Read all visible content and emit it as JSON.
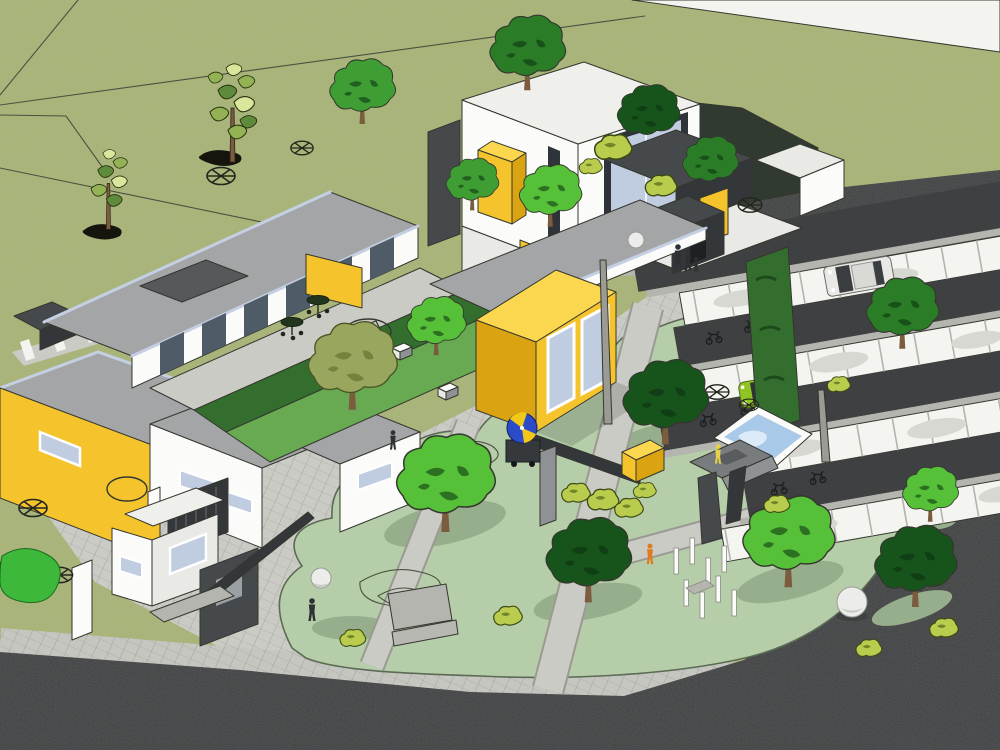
{
  "meta": {
    "title": "Aerial SketchUp-style render — community campus with parking and playground",
    "render_style": "3d architectural massing model, axonometric aerial view",
    "visible_text": "none"
  },
  "palette": {
    "grass": "#a7b476",
    "sketch_line": "#4c5140",
    "edge": "#34372e",
    "road_white": "#f3f3f0",
    "asphalt": "#3e4041",
    "sidewalk": "#c6c6c1",
    "plaza": "#cbcbc6",
    "parking_stall": "#f4f4f1",
    "curb": "#b5b5b0",
    "park_lawn": "#b5cda9",
    "lawn_outline": "#5c6b54",
    "lawn_shadow": "#97ae8c",
    "lawn_bright": "#67aa52",
    "hedge": "#346e2e",
    "roof_gray": "#a3a5a7",
    "roof_dark": "#56595c",
    "roof_white": "#efefec",
    "wall_white": "#fbfbf9",
    "wall_shade": "#e9e9e5",
    "wall_gray": "#8e9294",
    "wall_dark": "#46494c",
    "wall_darker": "#34373a",
    "fascia_blue": "#c5cfe3",
    "accent_yellow": "#f5c32c",
    "accent_yellow_light": "#fbd64f",
    "accent_yellow_shade": "#d9a312",
    "window_glass": "#c0cce0",
    "window_glass_dark": "#505b68",
    "window_frame": "#2f333a",
    "pond_blue": "#a9c9e8",
    "pond_light": "#dcebf7",
    "tree_bright": "#56c138",
    "tree_mid": "#3f9e33",
    "tree_dark": "#2a7d26",
    "tree_deep": "#17541b",
    "tree_olive": "#99a75e",
    "bush": "#b9cc4d",
    "trunk": "#7b5c3e",
    "trunk_gray": "#9b9b93",
    "car_green": "#8fc422",
    "car_silver": "#e9e9e6",
    "umbrella_dark": "#22351d",
    "umbrella_blue": "#2b4bc8",
    "umbrella_yellow": "#f2c818",
    "figure_dark": "#2e3134",
    "figure_orange": "#e07a1f",
    "figure_yellow": "#e8d24a",
    "sphere": "#ececea"
  },
  "scene": {
    "ground": [
      "grass field with sketch parcel lines",
      "white road top-right corner",
      "dark asphalt street along north-east",
      "dark asphalt perimeter road bottom and right",
      "hatched concrete plaza",
      "zebra walkway upper-left",
      "sage park lawns with paths"
    ],
    "buildings": [
      "L-shaped single-story wing with glazed courtyard facade",
      "two-story white tower with large corner window and yellow box",
      "yellow classroom box with two windows",
      "yellow flat-roof building west",
      "white annex buildings",
      "entry pavilion with dark panel and beam",
      "gate volume and canopy",
      "green hedge wall"
    ],
    "courtyard": [
      "gray patio",
      "3 cafe tables with dark umbrellas",
      "yellow wall panel",
      "olive tree",
      "white benches",
      "sketched play circle"
    ],
    "parking": [
      "4 white stall rows with dividers",
      "dark drive lanes",
      "silver car",
      "green compact car",
      "6 motorcycle clusters"
    ],
    "playground": [
      "dark angular climbing sculpture with child in yellow",
      "triangular blue pond",
      "yellow box bench",
      "white post cluster",
      "white sphere sculpture",
      "sphere street lamps",
      "vendor cart with blue-yellow umbrella"
    ],
    "vegetation": [
      "2 sketchy light trees NW",
      "dark tree cluster north",
      "bright and deep green park trees",
      "yellow-green bushes",
      "plan-symbol wheel trees"
    ],
    "people": [
      "two adults and child at gate",
      "walker near pavilion",
      "person in orange",
      "person near courtyard"
    ]
  }
}
